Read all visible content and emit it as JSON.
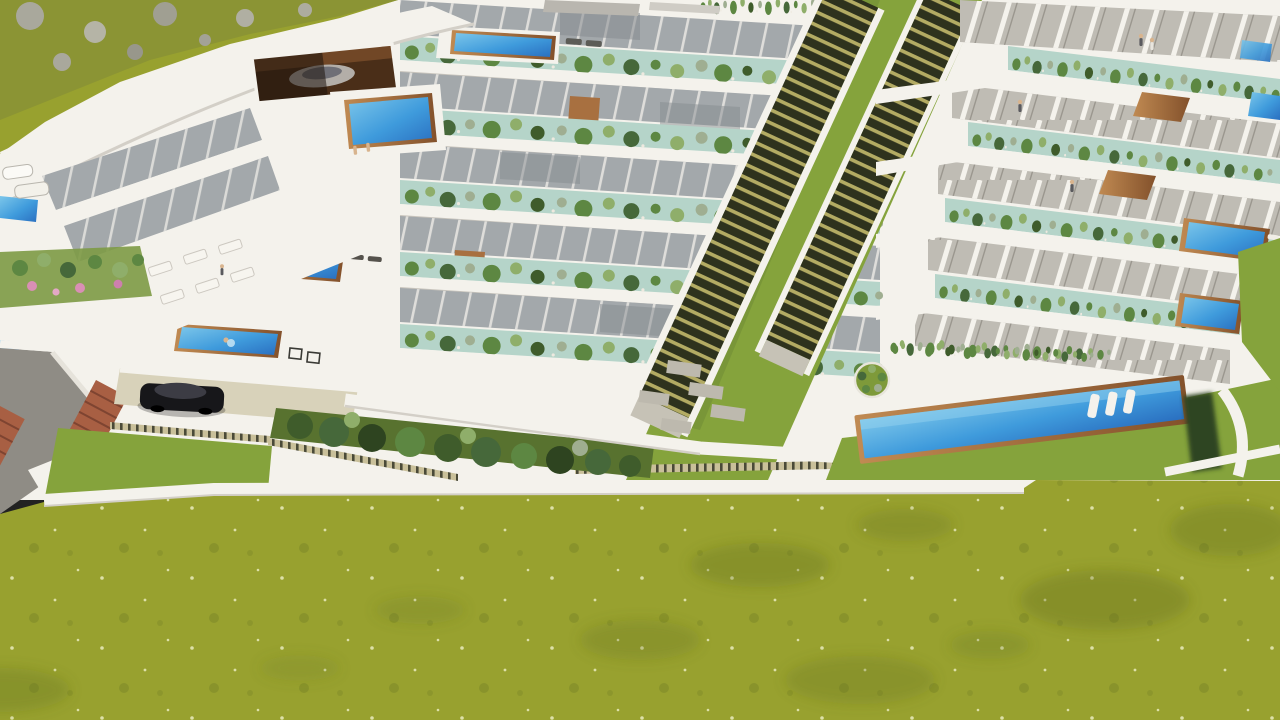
{
  "scene": {
    "type": "architectural-3d-render",
    "description": "Aerial 3D rendering of a terraced hillside residential complex: stepped white apartment blocks with roof-garden planters, private terraces with azure pools and wooden decks, a long central outdoor staircase between two wings, a communal lap pool with in-water loungers, a parked black car on a driveway, terracotta steps, an access road at lower left and a wide olive-green meadow in the foreground. No text is visible in the image.",
    "elements": {
      "hillside": "rocky green hillside, top-left corner",
      "curved_villa": "curved white clubhouse building with glass facade and garage",
      "left_terrace_block": "west wing: five stepped terrace levels with planter rows",
      "right_terrace_block": "east wing: stepped units with gardens, wood ramps and private pools",
      "central_staircase": "long twin staircase descending between the wings",
      "communal_pool": "large shared lap pool with three white loungers",
      "swimmer_pools": "terrace-end pools with swimmers",
      "car": "black car parked on beige driveway",
      "access_road": "gray asphalt road, bottom-left",
      "meadow": "olive-green grass field covering the foreground"
    },
    "people_count_visible": 9,
    "pools_count_visible": 10
  },
  "palette": {
    "white_fascia": "#f4f2ec",
    "white_shadow": "#dbd8d1",
    "wall_gray": "#bfbcb4",
    "glass_gray": "#a3a8ab",
    "glass_dark": "#868b90",
    "mullion_light": "#eceae4",
    "planter_edge": "#b5d4c9",
    "bush_green": "#5d8742",
    "bush_light": "#8fae6a",
    "bush_gray": "#9fae91",
    "bush_deep": "#46683a",
    "hedge_dark": "#3f5c2b",
    "hedge_black": "#2e4420",
    "lawn_bright": "#85a33c",
    "grass_field": "#98a12f",
    "grass_patch": "#5f6e1f",
    "grass_speckle": "#dde0a8",
    "pool_light": "#7cc6ea",
    "pool_blue": "#3f9bdc",
    "pool_deep": "#2a6fc0",
    "wood_brown": "#a87040",
    "wood_dark": "#83512b",
    "terracotta": "#a85f43",
    "stair_dark": "#2e321d",
    "stair_light": "#b3ab63",
    "road_gray": "#8f8c85",
    "drive_beige": "#d8d2ba",
    "car_black": "#17171a",
    "car_gloss": "#3c3c44",
    "garage_brown": "#4a2e18",
    "skin_tone": "#d8b48e"
  }
}
